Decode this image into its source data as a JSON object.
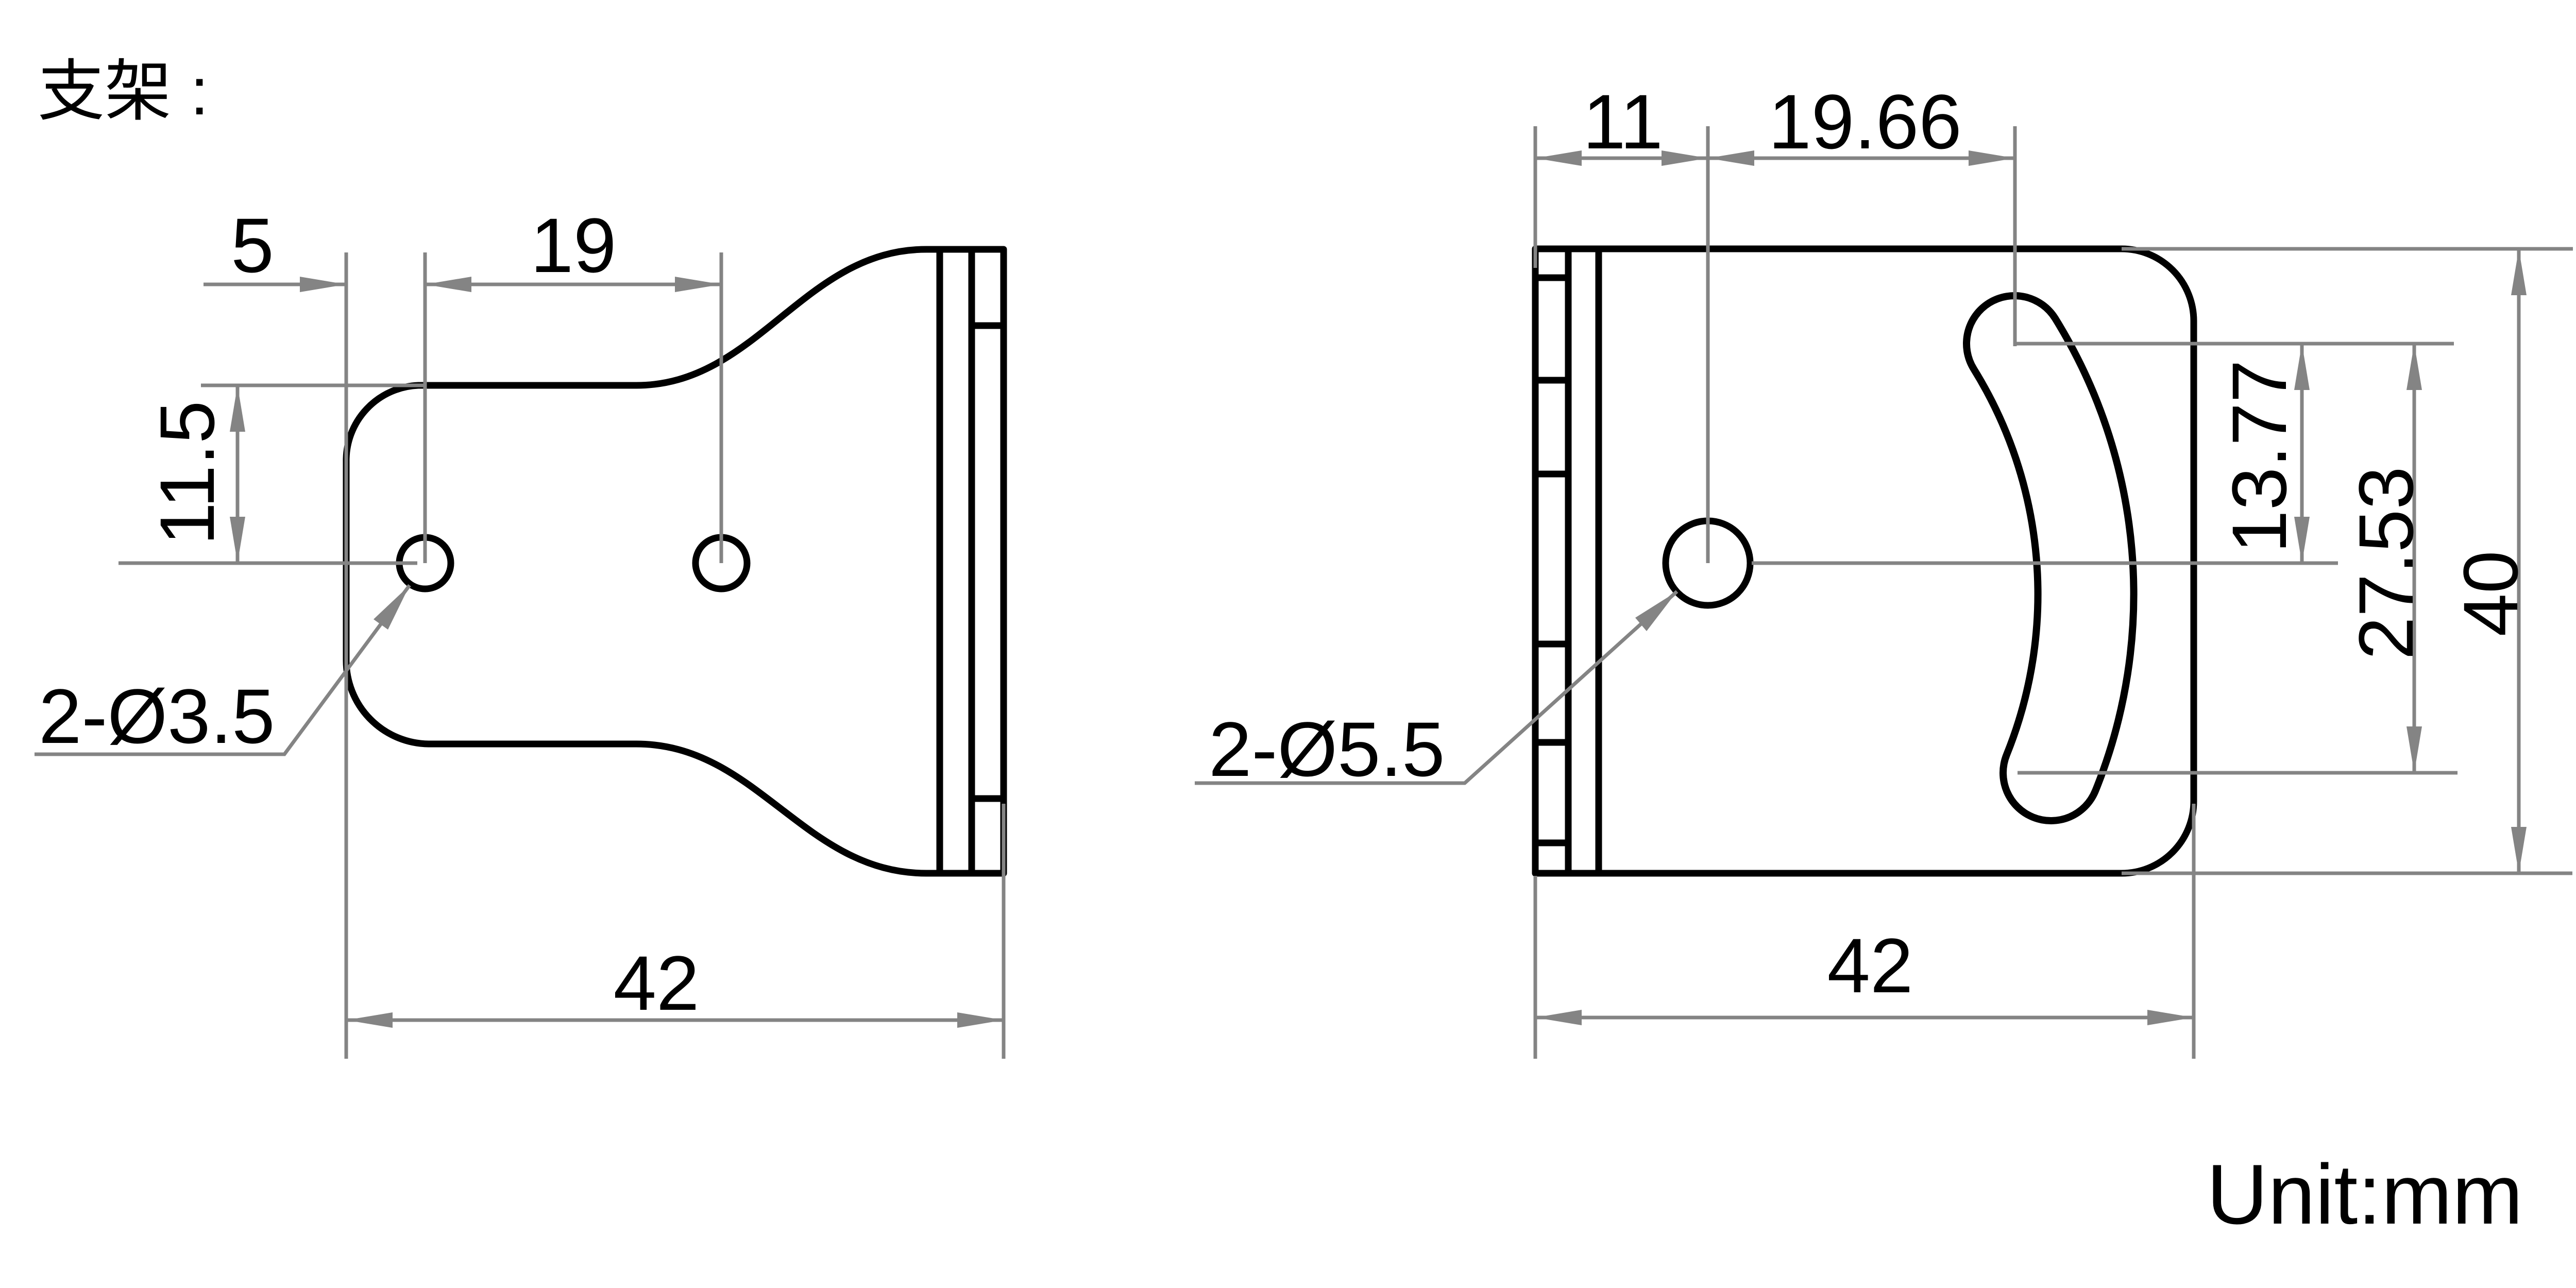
{
  "title": "支架 :",
  "unit_label": "Unit:mm",
  "colors": {
    "outline": "#000000",
    "dimension": "#848484",
    "background": "#ffffff"
  },
  "left_view": {
    "name": "bracket side profile view",
    "dims": {
      "edge_to_hole": "5",
      "hole_spacing": "19",
      "top_to_hole": "11.5",
      "overall_width": "42",
      "hole_callout": "2-Ø3.5"
    }
  },
  "right_view": {
    "name": "bracket front face view",
    "dims": {
      "edge_to_hole": "11",
      "hole_to_slot": "19.66",
      "slot_top_to_hole": "13.77",
      "slot_span": "27.53",
      "overall_height": "40",
      "overall_width": "42",
      "hole_callout": "2-Ø5.5"
    }
  }
}
